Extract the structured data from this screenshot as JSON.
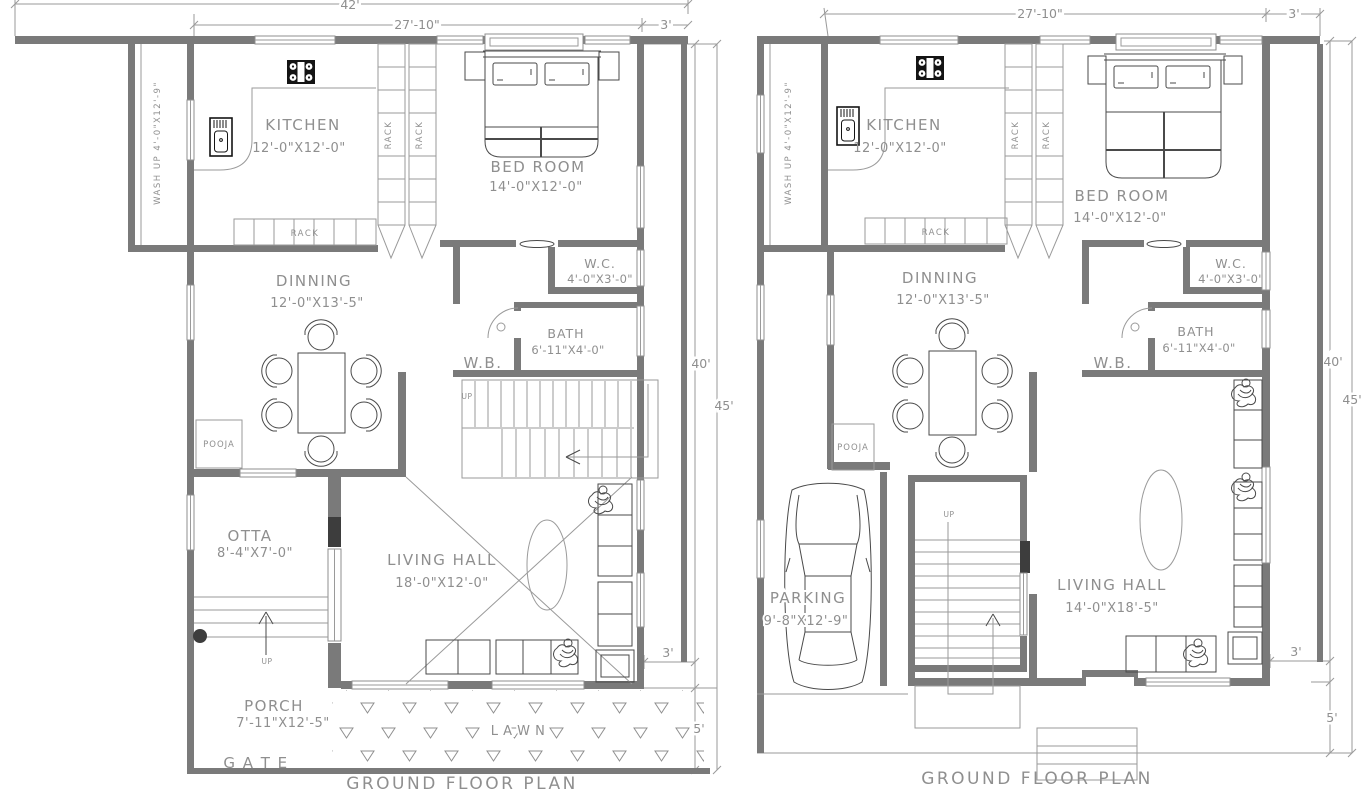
{
  "colors": {
    "wall": "#7a7a7a",
    "thin_line": "#9a9a9a",
    "furniture": "#4a4a4a",
    "text": "#8f8f8f",
    "accent_dark": "#141414",
    "background": "#ffffff"
  },
  "left": {
    "title": "GROUND FLOOR PLAN",
    "dims": {
      "total_width": "42'",
      "inner_width": "27'-10\"",
      "side_top": "3'",
      "depth_inner": "40'",
      "depth_total": "45'",
      "side_bottom": "3'",
      "front_setback": "5'"
    },
    "rooms": {
      "kitchen": {
        "name": "KITCHEN",
        "size": "12'-0\"X12'-0\""
      },
      "bedroom": {
        "name": "BED ROOM",
        "size": "14'-0\"X12'-0\""
      },
      "dinning": {
        "name": "DINNING",
        "size": "12'-0\"X13'-5\""
      },
      "wc": {
        "name": "W.C.",
        "size": "4'-0\"X3'-0\""
      },
      "bath": {
        "name": "BATH",
        "size": "6'-11\"X4'-0\""
      },
      "wb": {
        "name": "W.B."
      },
      "otta": {
        "name": "OTTA",
        "size": "8'-4\"X7'-0\""
      },
      "living": {
        "name": "LIVING HALL",
        "size": "18'-0\"X12'-0\""
      },
      "porch": {
        "name": "PORCH",
        "size": "7'-11\"X12'-5\""
      },
      "wash": {
        "label": "WASH UP 4'-0\"X12'-9\""
      },
      "pooja": {
        "name": "POOJA"
      }
    },
    "labels": {
      "rack": "RACK",
      "up": "UP",
      "lawn": "L A W N",
      "gate": "G A T E"
    }
  },
  "right": {
    "title": "GROUND FLOOR PLAN",
    "dims": {
      "inner_width": "27'-10\"",
      "side_top": "3'",
      "depth_inner": "40'",
      "depth_total": "45'",
      "side_bottom": "3'",
      "front_setback": "5'"
    },
    "rooms": {
      "kitchen": {
        "name": "KITCHEN",
        "size": "12'-0\"X12'-0\""
      },
      "bedroom": {
        "name": "BED ROOM",
        "size": "14'-0\"X12'-0\""
      },
      "dinning": {
        "name": "DINNING",
        "size": "12'-0\"X13'-5\""
      },
      "wc": {
        "name": "W.C.",
        "size": "4'-0\"X3'-0\""
      },
      "bath": {
        "name": "BATH",
        "size": "6'-11\"X4'-0\""
      },
      "wb": {
        "name": "W.B."
      },
      "parking": {
        "name": "PARKING",
        "size": "9'-8\"X12'-9\""
      },
      "living": {
        "name": "LIVING HALL",
        "size": "14'-0\"X18'-5\""
      },
      "wash": {
        "label": "WASH UP 4'-0\"X12'-9\""
      },
      "pooja": {
        "name": "POOJA"
      }
    },
    "labels": {
      "rack": "RACK",
      "up": "UP"
    }
  }
}
